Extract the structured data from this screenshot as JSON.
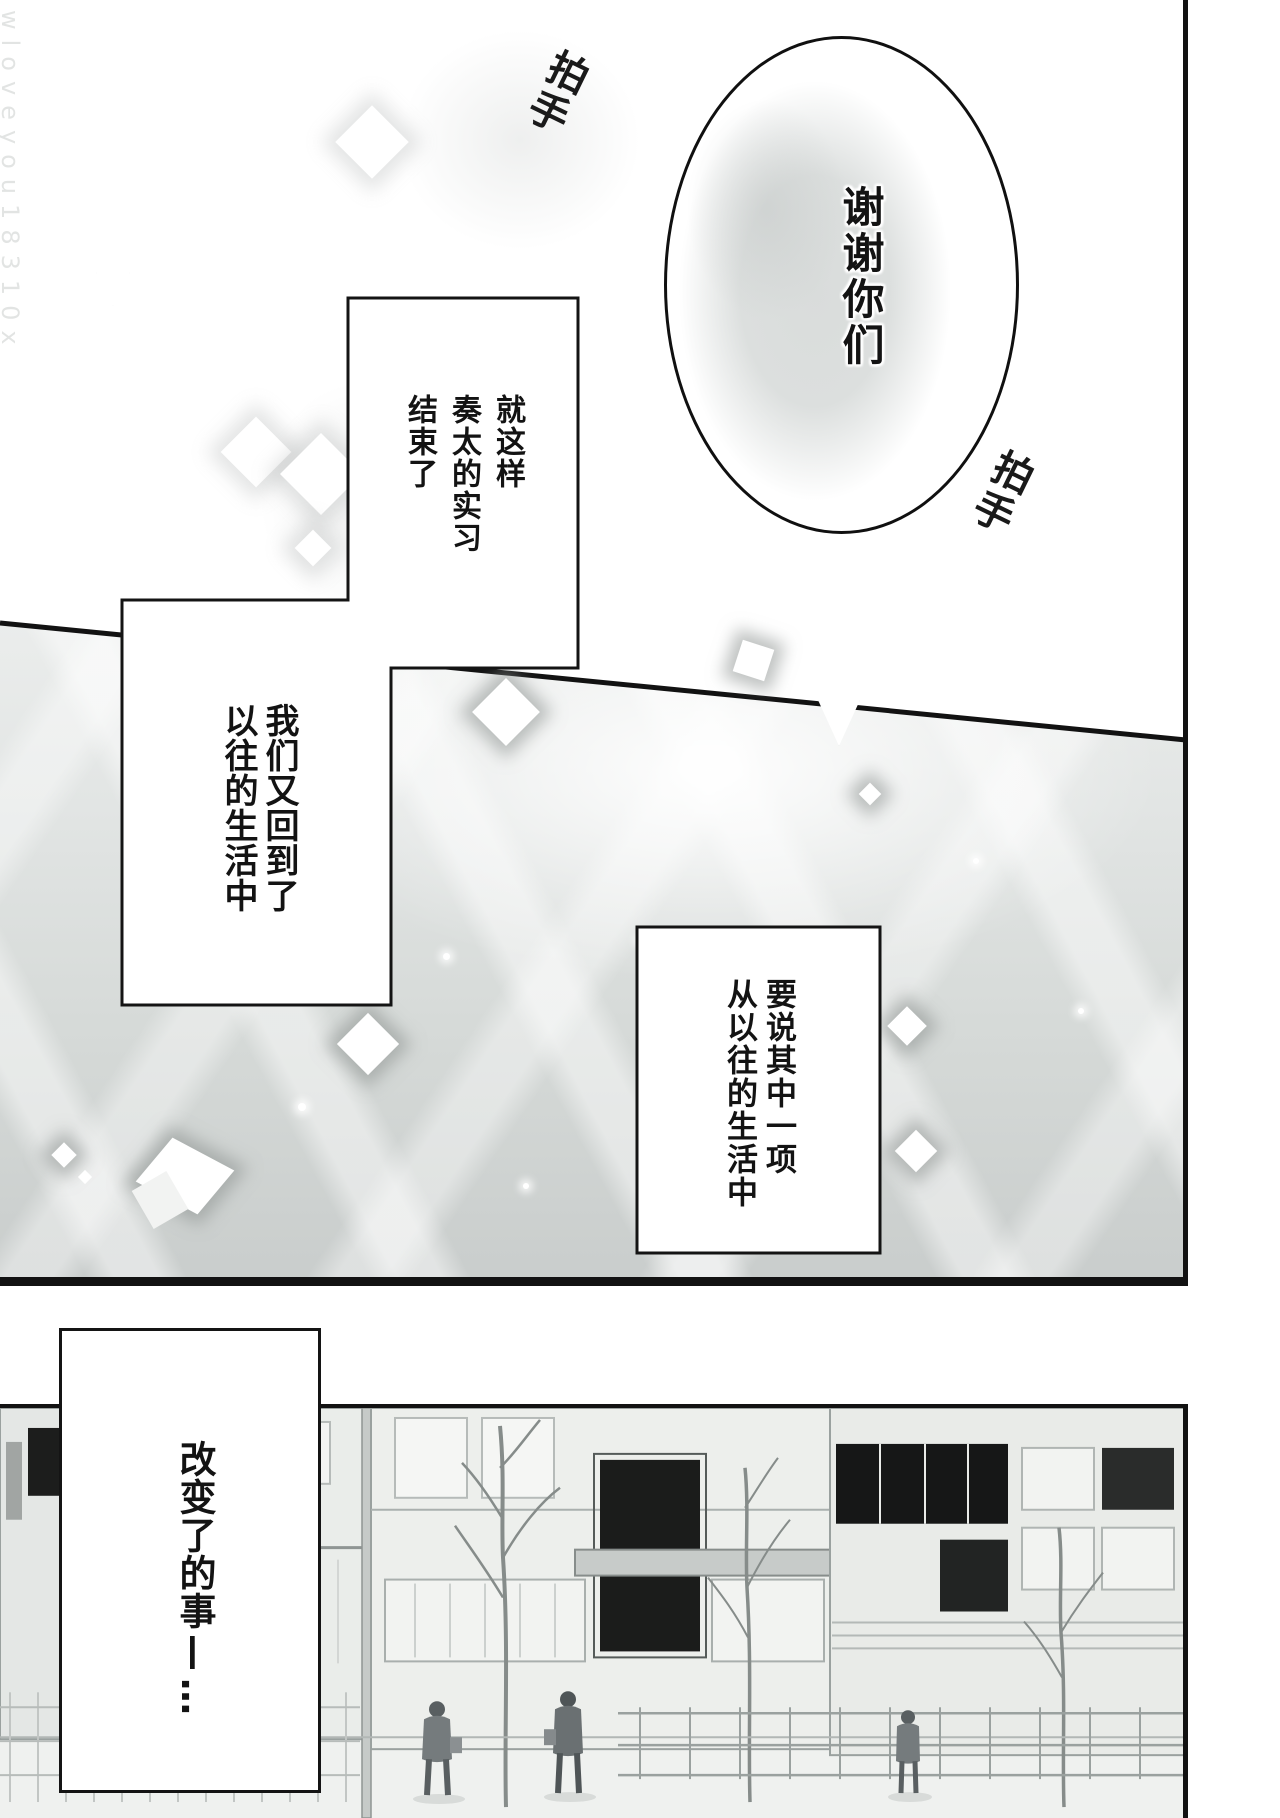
{
  "page": {
    "type": "manga-page",
    "width": 1280,
    "height": 1818
  },
  "colors": {
    "ink": "#131313",
    "paper": "#ffffff",
    "panel2_top": "#eceeed",
    "panel2_bottom": "#c9cdcc"
  },
  "watermark": {
    "text": "wloveyou18310x"
  },
  "panel1": {
    "speech_bubble": {
      "text": "谢谢你们"
    },
    "sfx_clap_top": "拍手",
    "sfx_clap_right": "拍手"
  },
  "panel2": {
    "caption_box_1": {
      "text": "就这样\n奏太的实习\n结束了"
    },
    "caption_box_2": {
      "text": "我们又回到了\n以往的生活中"
    },
    "caption_box_3": {
      "text": "要说其中一项\n从以往的生活中"
    }
  },
  "panel3": {
    "caption_box_4": {
      "text": "改变了的事",
      "dash": "—",
      "ellipsis": "…"
    }
  }
}
